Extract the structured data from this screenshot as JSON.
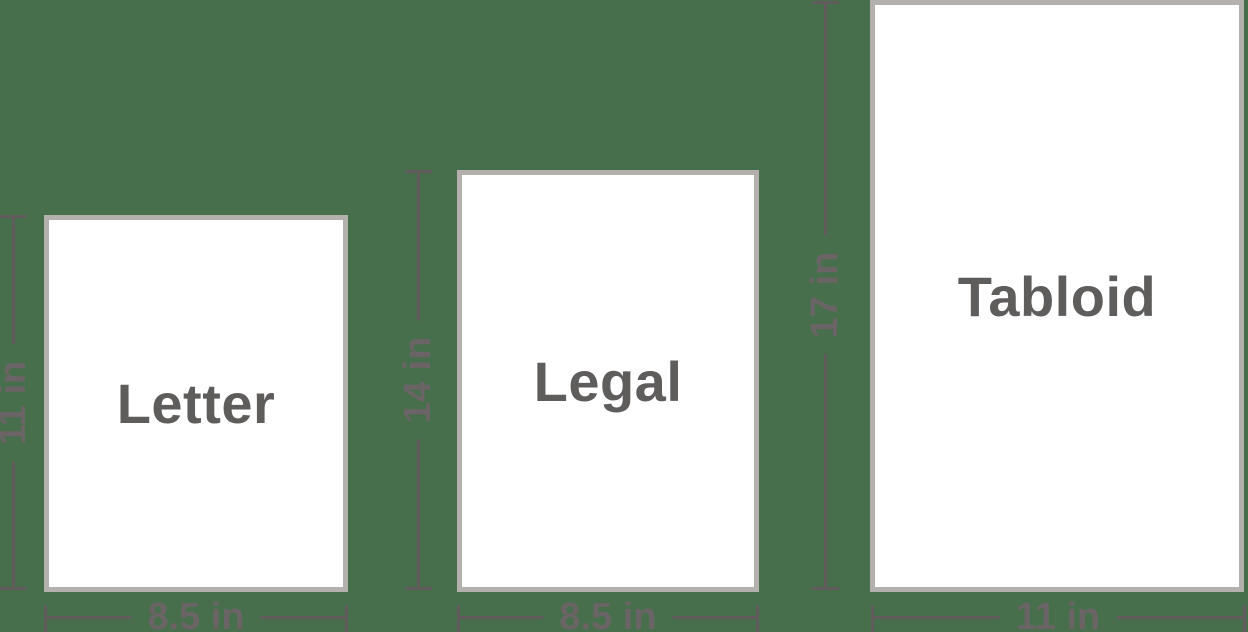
{
  "colors": {
    "background": "#486f4c",
    "dimension_line": "#615b5d",
    "dimension_text": "#6a6466",
    "paper_fill": "#ffffff",
    "paper_border": "#b3b0ae",
    "label_text": "#5f5c5c"
  },
  "papers": [
    {
      "name": "Letter",
      "width_label": "8.5 in",
      "height_label": "11 in"
    },
    {
      "name": "Legal",
      "width_label": "8.5 in",
      "height_label": "14 in"
    },
    {
      "name": "Tabloid",
      "width_label": "11 in",
      "height_label": "17 in"
    }
  ]
}
